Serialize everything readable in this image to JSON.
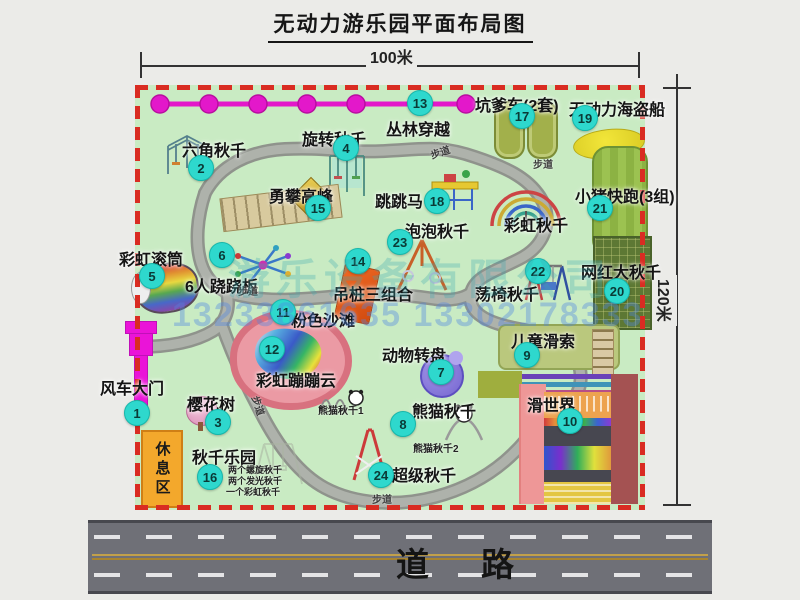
{
  "title": "无动力游乐园平面布局图",
  "dimensions": {
    "width_label": "100米",
    "height_label": "120米"
  },
  "road": {
    "label": "道路"
  },
  "watermark": {
    "company": "游乐设备有限公司",
    "phones": "13233861635 13302178333"
  },
  "rest_area": {
    "label": "休息区"
  },
  "colors": {
    "map_green": "#c9ebc3",
    "border_red": "#d92c22",
    "badge_cyan": "#2ed8cd",
    "zipline_magenta": "#e618ca",
    "gate_magenta": "#ea14d8",
    "road_gray": "#6f7077",
    "rest_orange": "#f3a82c"
  },
  "park": {
    "path_label_text": "步道",
    "path_labels": [
      {
        "x": 430,
        "y": 144,
        "rot": -18
      },
      {
        "x": 533,
        "y": 156,
        "rot": 0
      },
      {
        "x": 238,
        "y": 283,
        "rot": 0
      },
      {
        "x": 249,
        "y": 398,
        "rot": 72
      },
      {
        "x": 372,
        "y": 491,
        "rot": 0
      }
    ],
    "small_labels": [
      {
        "text": "熊猫秋千1",
        "x": 318,
        "y": 402,
        "size": 10
      },
      {
        "text": "熊猫秋千2",
        "x": 413,
        "y": 440,
        "size": 10
      },
      {
        "text": "两个螺旋秋千",
        "x": 228,
        "y": 463,
        "size": 9
      },
      {
        "text": "两个发光秋千",
        "x": 228,
        "y": 474,
        "size": 9
      },
      {
        "text": "一个彩虹秋千",
        "x": 226,
        "y": 485,
        "size": 9
      }
    ],
    "attractions": [
      {
        "num": 1,
        "name": "风车大门",
        "bx": 136,
        "by": 412,
        "lx": 100,
        "ly": 375
      },
      {
        "num": 2,
        "name": "六角秋千",
        "bx": 200,
        "by": 167,
        "lx": 182,
        "ly": 137
      },
      {
        "num": 3,
        "name": "樱花树",
        "bx": 217,
        "by": 421,
        "lx": 187,
        "ly": 391
      },
      {
        "num": 4,
        "name": "旋转秋千",
        "bx": 345,
        "by": 147,
        "lx": 302,
        "ly": 126
      },
      {
        "num": 5,
        "name": "彩虹滚筒",
        "bx": 151,
        "by": 275,
        "lx": 119,
        "ly": 246
      },
      {
        "num": 6,
        "name": "6人跷跷板",
        "bx": 221,
        "by": 254,
        "lx": 185,
        "ly": 273
      },
      {
        "num": 7,
        "name": "动物转盘",
        "bx": 440,
        "by": 371,
        "lx": 382,
        "ly": 342
      },
      {
        "num": 8,
        "name": "熊猫秋千",
        "bx": 402,
        "by": 423,
        "lx": 412,
        "ly": 398
      },
      {
        "num": 9,
        "name": "儿童滑索",
        "bx": 526,
        "by": 354,
        "lx": 511,
        "ly": 328
      },
      {
        "num": 10,
        "name": "滑世界",
        "bx": 569,
        "by": 420,
        "lx": 527,
        "ly": 392
      },
      {
        "num": 11,
        "name": "粉色沙滩",
        "bx": 282,
        "by": 311,
        "lx": 291,
        "ly": 307
      },
      {
        "num": 12,
        "name": "彩虹蹦蹦云",
        "bx": 271,
        "by": 348,
        "lx": 256,
        "ly": 367
      },
      {
        "num": 13,
        "name": "丛林穿越",
        "bx": 419,
        "by": 102,
        "lx": 386,
        "ly": 116
      },
      {
        "num": 14,
        "name": "吊桩三组合",
        "bx": 357,
        "by": 260,
        "lx": 333,
        "ly": 281
      },
      {
        "num": 15,
        "name": "勇攀高峰",
        "bx": 317,
        "by": 207,
        "lx": 269,
        "ly": 183
      },
      {
        "num": 16,
        "name": "秋千乐园",
        "bx": 209,
        "by": 476,
        "lx": 192,
        "ly": 444
      },
      {
        "num": 17,
        "name": "坑爹车(2套)",
        "bx": 521,
        "by": 115,
        "lx": 475,
        "ly": 92
      },
      {
        "num": 18,
        "name": "跳跳马",
        "bx": 436,
        "by": 200,
        "lx": 375,
        "ly": 188
      },
      {
        "num": 19,
        "name": "无动力海盗船",
        "bx": 584,
        "by": 117,
        "lx": 569,
        "ly": 96
      },
      {
        "num": 20,
        "name": "网红大秋千",
        "bx": 616,
        "by": 290,
        "lx": 581,
        "ly": 259
      },
      {
        "num": 21,
        "name": "小猪快跑(3组)",
        "bx": 599,
        "by": 207,
        "lx": 575,
        "ly": 183
      },
      {
        "num": 22,
        "name": "荡椅秋千",
        "bx": 537,
        "by": 270,
        "lx": 475,
        "ly": 281
      },
      {
        "num": 23,
        "name": "泡泡秋千",
        "bx": 399,
        "by": 241,
        "lx": 405,
        "ly": 218
      },
      {
        "num": 24,
        "name": "超级秋千",
        "bx": 380,
        "by": 474,
        "lx": 392,
        "ly": 462
      },
      {
        "num": null,
        "name": "彩虹秋千",
        "lx": 504,
        "ly": 212
      }
    ]
  }
}
